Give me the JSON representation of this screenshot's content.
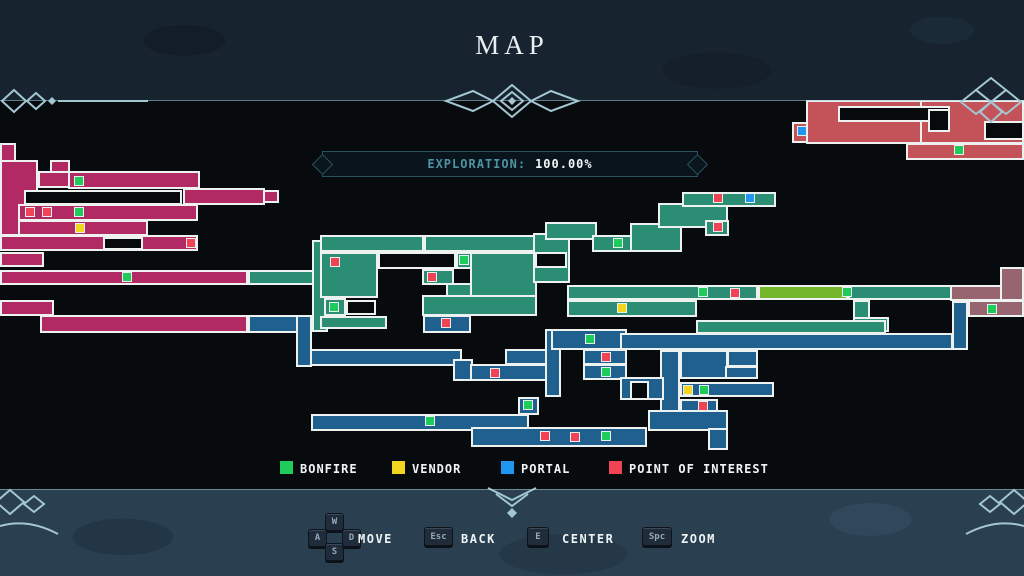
{
  "title": "MAP",
  "exploration": {
    "label": "EXPLORATION:",
    "value": "100.00%"
  },
  "legend": {
    "items": [
      {
        "id": "bonfire",
        "label": "BONFIRE",
        "color": "#1ecb5b"
      },
      {
        "id": "vendor",
        "label": "VENDOR",
        "color": "#f3d41e"
      },
      {
        "id": "portal",
        "label": "PORTAL",
        "color": "#2196f0"
      },
      {
        "id": "poi",
        "label": "POINT OF INTEREST",
        "color": "#f04356"
      }
    ]
  },
  "controls": {
    "keys": {
      "w": "W",
      "a": "A",
      "s": "S",
      "d": "D",
      "esc": "Esc",
      "e": "E",
      "spc": "Spc"
    },
    "labels": {
      "move": "MOVE",
      "back": "BACK",
      "center": "CENTER",
      "zoom": "ZOOM"
    }
  },
  "map": {
    "palette": {
      "p": "#b12a63",
      "t": "#2b8e74",
      "b": "#20608f",
      "s": "#c35359",
      "m": "#966570",
      "l": "#74b72c"
    },
    "rooms": [
      [
        "p",
        0,
        143,
        16,
        19
      ],
      [
        "p",
        0,
        160,
        38,
        76
      ],
      [
        "p",
        50,
        160,
        20,
        13
      ],
      [
        "p",
        38,
        171,
        32,
        17
      ],
      [
        "p",
        68,
        171,
        132,
        18
      ],
      [
        "p",
        183,
        188,
        82,
        17
      ],
      [
        "p",
        263,
        190,
        16,
        13
      ],
      [
        "p",
        18,
        204,
        180,
        17
      ],
      [
        "p",
        18,
        220,
        130,
        16
      ],
      [
        "p",
        0,
        235,
        198,
        16
      ],
      [
        "p",
        0,
        252,
        44,
        15
      ],
      [
        "p",
        0,
        270,
        248,
        15
      ],
      [
        "p",
        0,
        300,
        54,
        16
      ],
      [
        "p",
        40,
        315,
        208,
        18
      ],
      [
        "t",
        248,
        270,
        78,
        15
      ],
      [
        "t",
        312,
        240,
        16,
        92
      ],
      [
        "t",
        320,
        235,
        104,
        17
      ],
      [
        "t",
        424,
        235,
        113,
        17
      ],
      [
        "t",
        456,
        252,
        18,
        17
      ],
      [
        "t",
        320,
        252,
        58,
        46
      ],
      [
        "t",
        470,
        252,
        67,
        46
      ],
      [
        "t",
        422,
        269,
        32,
        16
      ],
      [
        "t",
        446,
        283,
        26,
        14
      ],
      [
        "t",
        422,
        295,
        115,
        21
      ],
      [
        "t",
        324,
        298,
        22,
        18
      ],
      [
        "t",
        320,
        316,
        67,
        13
      ],
      [
        "t",
        533,
        233,
        37,
        50
      ],
      [
        "t",
        545,
        222,
        52,
        18
      ],
      [
        "t",
        592,
        235,
        46,
        17
      ],
      [
        "t",
        630,
        223,
        52,
        29
      ],
      [
        "t",
        658,
        203,
        70,
        25
      ],
      [
        "t",
        682,
        192,
        94,
        15
      ],
      [
        "t",
        705,
        220,
        24,
        16
      ],
      [
        "t",
        567,
        285,
        191,
        15
      ],
      [
        "l",
        758,
        285,
        90,
        15
      ],
      [
        "t",
        848,
        285,
        104,
        15
      ],
      [
        "t",
        567,
        300,
        130,
        17
      ],
      [
        "t",
        853,
        300,
        17,
        32
      ],
      [
        "t",
        853,
        317,
        36,
        15
      ],
      [
        "t",
        696,
        320,
        190,
        14
      ],
      [
        "s",
        806,
        100,
        146,
        44
      ],
      [
        "s",
        792,
        122,
        16,
        21
      ],
      [
        "s",
        920,
        100,
        104,
        44
      ],
      [
        "s",
        906,
        143,
        118,
        17
      ],
      [
        "m",
        950,
        285,
        52,
        16
      ],
      [
        "m",
        1000,
        267,
        24,
        34
      ],
      [
        "m",
        968,
        300,
        56,
        17
      ],
      [
        "b",
        248,
        315,
        50,
        18
      ],
      [
        "b",
        296,
        315,
        16,
        52
      ],
      [
        "b",
        423,
        315,
        48,
        18
      ],
      [
        "b",
        310,
        349,
        152,
        17
      ],
      [
        "b",
        453,
        359,
        20,
        22
      ],
      [
        "b",
        470,
        364,
        84,
        17
      ],
      [
        "b",
        505,
        349,
        46,
        16
      ],
      [
        "b",
        545,
        329,
        16,
        68
      ],
      [
        "b",
        551,
        329,
        76,
        21
      ],
      [
        "b",
        583,
        349,
        44,
        16
      ],
      [
        "b",
        583,
        364,
        44,
        16
      ],
      [
        "b",
        518,
        397,
        21,
        18
      ],
      [
        "b",
        311,
        414,
        218,
        17
      ],
      [
        "b",
        471,
        427,
        176,
        20
      ],
      [
        "b",
        620,
        333,
        333,
        17
      ],
      [
        "b",
        952,
        301,
        16,
        49
      ],
      [
        "b",
        660,
        350,
        20,
        66
      ],
      [
        "b",
        680,
        350,
        48,
        29
      ],
      [
        "b",
        727,
        350,
        31,
        17
      ],
      [
        "b",
        725,
        366,
        33,
        13
      ],
      [
        "b",
        620,
        377,
        44,
        23
      ],
      [
        "b",
        680,
        382,
        94,
        15
      ],
      [
        "b",
        680,
        399,
        38,
        14
      ],
      [
        "b",
        648,
        410,
        80,
        21
      ],
      [
        "b",
        708,
        428,
        20,
        22
      ]
    ],
    "holes": [
      [
        24,
        190,
        158,
        15
      ],
      [
        103,
        237,
        40,
        13
      ],
      [
        378,
        252,
        78,
        17
      ],
      [
        346,
        300,
        30,
        15
      ],
      [
        535,
        252,
        32,
        16
      ],
      [
        838,
        106,
        112,
        16
      ],
      [
        984,
        121,
        40,
        19
      ],
      [
        928,
        109,
        22,
        23
      ],
      [
        630,
        381,
        19,
        19
      ]
    ],
    "icons": [
      [
        "portal",
        797,
        126
      ],
      [
        "portal",
        745,
        193
      ],
      [
        "vendor",
        75,
        223
      ],
      [
        "vendor",
        617,
        303
      ],
      [
        "vendor",
        683,
        385
      ],
      [
        "bonfire",
        74,
        176
      ],
      [
        "bonfire",
        74,
        207
      ],
      [
        "bonfire",
        122,
        272
      ],
      [
        "bonfire",
        329,
        302
      ],
      [
        "bonfire",
        459,
        255
      ],
      [
        "bonfire",
        613,
        238
      ],
      [
        "bonfire",
        698,
        287
      ],
      [
        "bonfire",
        842,
        287
      ],
      [
        "bonfire",
        585,
        334
      ],
      [
        "bonfire",
        601,
        367
      ],
      [
        "bonfire",
        523,
        400
      ],
      [
        "bonfire",
        425,
        416
      ],
      [
        "bonfire",
        601,
        431
      ],
      [
        "bonfire",
        699,
        385
      ],
      [
        "bonfire",
        954,
        145
      ],
      [
        "bonfire",
        987,
        304
      ],
      [
        "poi",
        25,
        207
      ],
      [
        "poi",
        42,
        207
      ],
      [
        "poi",
        186,
        238
      ],
      [
        "poi",
        330,
        257
      ],
      [
        "poi",
        427,
        272
      ],
      [
        "poi",
        713,
        193
      ],
      [
        "poi",
        713,
        222
      ],
      [
        "poi",
        730,
        288
      ],
      [
        "poi",
        441,
        318
      ],
      [
        "poi",
        490,
        368
      ],
      [
        "poi",
        601,
        352
      ],
      [
        "poi",
        698,
        401
      ],
      [
        "poi",
        540,
        431
      ],
      [
        "poi",
        570,
        432
      ]
    ]
  }
}
